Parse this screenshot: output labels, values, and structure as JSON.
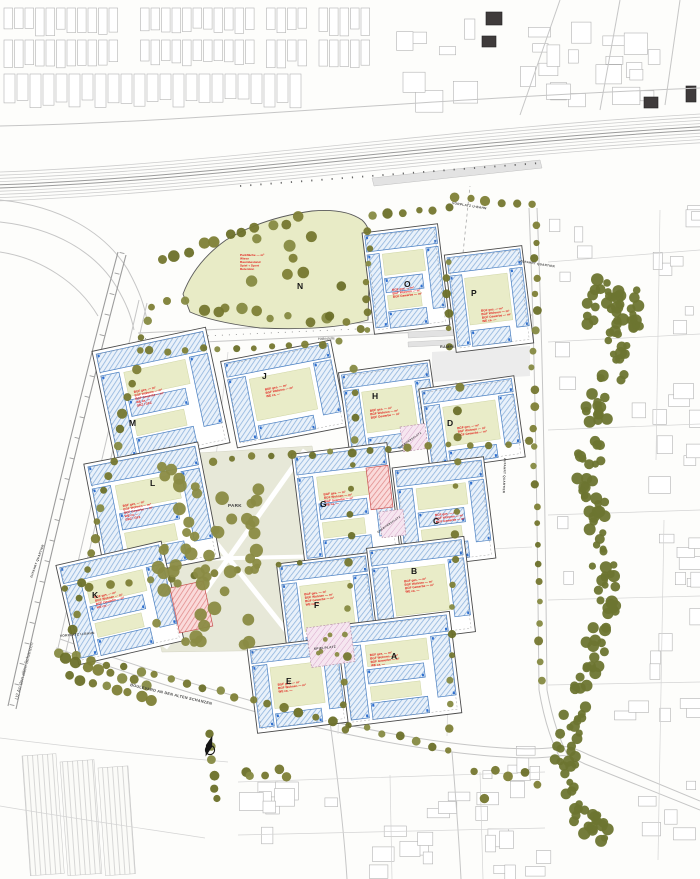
{
  "blocks": {
    "A": {
      "letter": "A",
      "ann": [
        "BGF ges. — m²",
        "BGF Wohnen — m²",
        "BGF Gewerbe — m²",
        "WE ca. —"
      ]
    },
    "B": {
      "letter": "B",
      "ann": [
        "BGF ges. — m²",
        "BGF Wohnen — m²",
        "BGF Gewerbe — m²",
        "WE ca. —"
      ]
    },
    "C": {
      "letter": "C",
      "ann": [
        "BGF ges. — m²",
        "BGF Wohnen — m²",
        "BGF Gewerbe — m²"
      ]
    },
    "D": {
      "letter": "D",
      "ann": [
        "BGF ges. — m²",
        "BGF Wohnen — m²",
        "BGF Gewerbe — m²"
      ]
    },
    "E": {
      "letter": "E",
      "ann": [
        "BGF ges. — m²",
        "BGF Wohnen — m²",
        "WE ca. —"
      ]
    },
    "F": {
      "letter": "F",
      "ann": [
        "BGF ges. — m²",
        "BGF Wohnen — m²",
        "BGF Gewerbe — m²",
        "WE ca. —"
      ]
    },
    "G": {
      "letter": "G",
      "ann": [
        "BGF ges. — m²",
        "BGF Wohnen — m²",
        "BGF Gewerbe — m²",
        "WE ca. —"
      ]
    },
    "H": {
      "letter": "H",
      "ann": [
        "BGF ges. — m²",
        "BGF Wohnen — m²",
        "BGF Gewerbe — m²"
      ]
    },
    "J": {
      "letter": "J",
      "ann": [
        "BGF ges. — m²",
        "BGF Wohnen — m²",
        "WE ca. —"
      ]
    },
    "K": {
      "letter": "K",
      "ann": [
        "BGF ges. — m²",
        "BGF Wohnen — m²",
        "BGF Gewerbe — m²",
        "WE ca. —"
      ]
    },
    "L": {
      "letter": "L",
      "ann": [
        "BGF ges. — m²",
        "BGF Wohnen — m²",
        "BGF Gewerbe — m²",
        "WE ca. —",
        "GRZ / GFZ"
      ]
    },
    "M": {
      "letter": "M",
      "ann": [
        "BGF ges. — m²",
        "BGF Wohnen — m²",
        "BGF Gewerbe — m²",
        "WE ca. —",
        "GRZ / GFZ"
      ]
    },
    "N": {
      "letter": "N",
      "ann": [
        "Parkfläche — m²",
        "Wiese",
        "Baumbestand",
        "Spiel + Sport",
        "Retention"
      ]
    },
    "O": {
      "letter": "O",
      "ann": [
        "BGF ges. — m²",
        "BGF Wohnen — m²",
        "BGF Gewerbe — m²"
      ]
    },
    "P": {
      "letter": "P",
      "ann": [
        "BGF ges. — m²",
        "BGF Wohnen — m²",
        "BGF Gewerbe — m²",
        "WE ca. —"
      ]
    }
  },
  "streets": {
    "haltestelle": "Haltestelle",
    "u2": "U2 An den alten Schanzen",
    "boulevard": "BOULEVARD AN DEN ALTEN SCHANZEN",
    "zufahrt": "ZUFAHRT QUARTIER",
    "vorplatz_ubahn": "VORPLATZ U-BAHN",
    "rampe": "RAMPE",
    "park": "PARK"
  },
  "places": {
    "quartiersplatz": "QUARTIERSPLATZ",
    "spielplatz": "SPIELPLATZ"
  },
  "legend_colors": {
    "building_hatch_blue": "#4a7fc1",
    "courtyard_green": "#e9ecc8",
    "tree_olive": "#75772f",
    "annotation_red": "#e2211c",
    "platz_pink": "#f3dcea"
  }
}
